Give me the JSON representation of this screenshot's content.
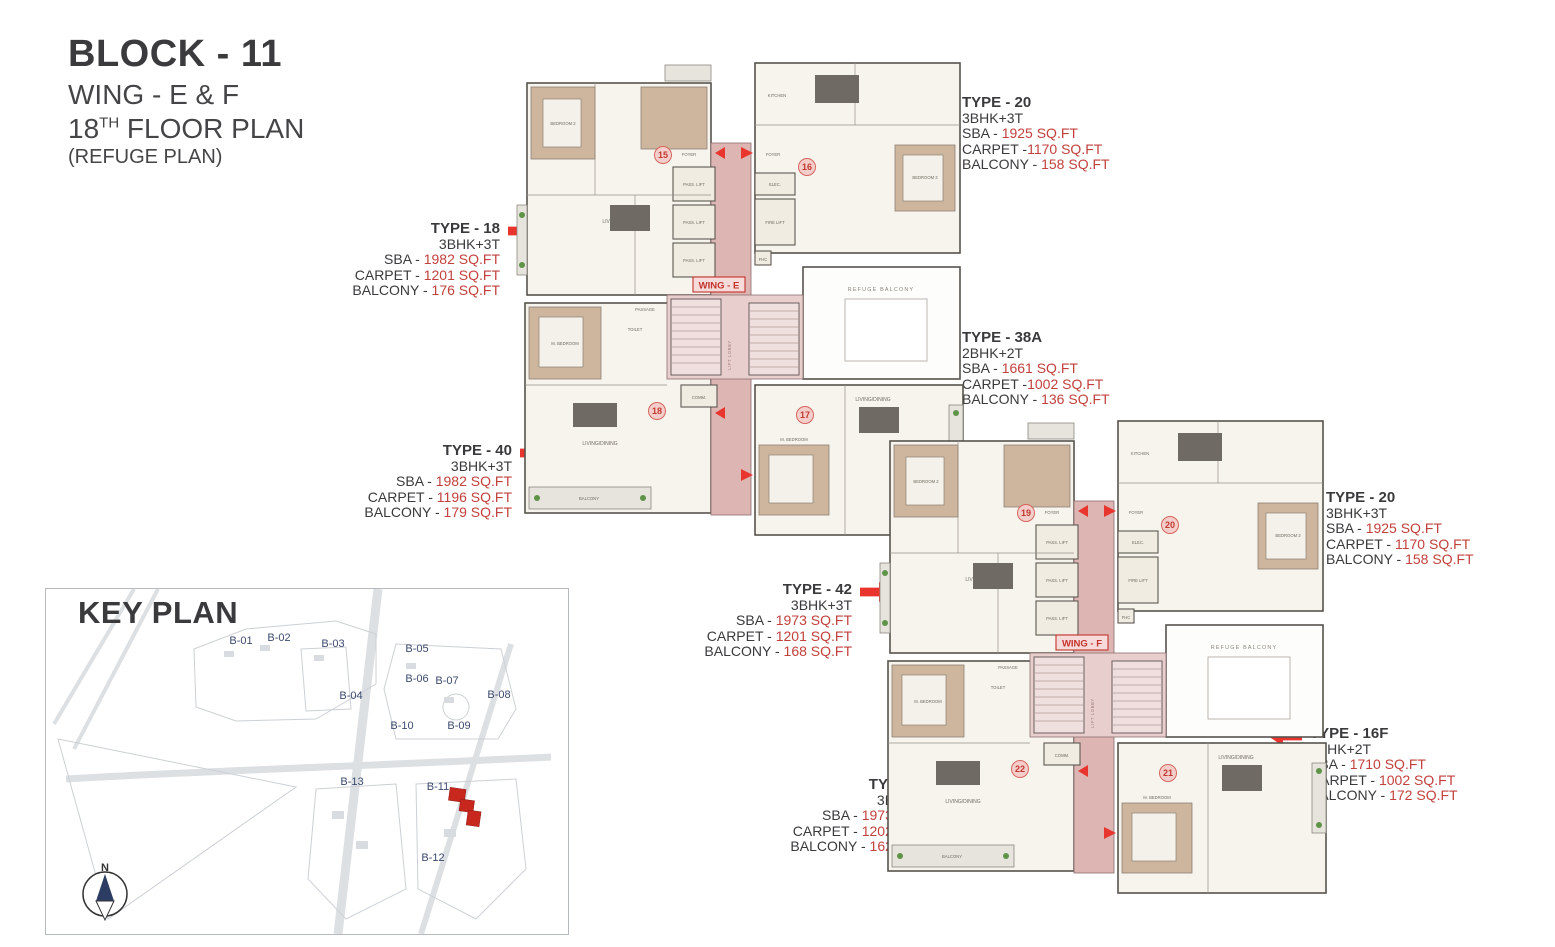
{
  "title": {
    "block": "BLOCK - 11",
    "wing": "WING - E & F",
    "floor_num": "18",
    "floor_sup": "TH",
    "floor_rest": " FLOOR PLAN",
    "subtitle": "(REFUGE PLAN)"
  },
  "colors": {
    "arrow_red": "#e8342c",
    "value_red": "#c2413d",
    "corridor_pink": "#ddb6b4",
    "keyplan_navy": "#3c4a6e"
  },
  "type_cards": [
    {
      "label": "TYPE - 20",
      "config": "3BHK+3T",
      "sba_label": "SBA - ",
      "sba": "1925 SQ.FT",
      "carpet_label": "CARPET -",
      "carpet": "1170 SQ.FT",
      "balcony_label": "BALCONY - ",
      "balcony": "158 SQ.FT"
    },
    {
      "label": "TYPE - 18",
      "config": "3BHK+3T",
      "sba_label": "SBA - ",
      "sba": "1982 SQ.FT",
      "carpet_label": "CARPET - ",
      "carpet": "1201 SQ.FT",
      "balcony_label": "BALCONY - ",
      "balcony": "176 SQ.FT"
    },
    {
      "label": "TYPE - 38A",
      "config": "2BHK+2T",
      "sba_label": "SBA - ",
      "sba": "1661 SQ.FT",
      "carpet_label": "CARPET -",
      "carpet": "1002 SQ.FT",
      "balcony_label": "BALCONY - ",
      "balcony": "136 SQ.FT"
    },
    {
      "label": "TYPE - 40",
      "config": "3BHK+3T",
      "sba_label": "SBA - ",
      "sba": "1982 SQ.FT",
      "carpet_label": "CARPET - ",
      "carpet": "1196 SQ.FT",
      "balcony_label": "BALCONY - ",
      "balcony": "179 SQ.FT"
    },
    {
      "label": "TYPE - 20",
      "config": "3BHK+3T",
      "sba_label": "SBA - ",
      "sba": "1925 SQ.FT",
      "carpet_label": "CARPET - ",
      "carpet": "1170 SQ.FT",
      "balcony_label": "BALCONY - ",
      "balcony": "158 SQ.FT"
    },
    {
      "label": "TYPE - 42",
      "config": "3BHK+3T",
      "sba_label": "SBA - ",
      "sba": "1973 SQ.FT",
      "carpet_label": "CARPET - ",
      "carpet": "1201 SQ.FT",
      "balcony_label": "BALCONY - ",
      "balcony": "168 SQ.FT"
    },
    {
      "label": "TYPE - 16F",
      "config": "2BHK+2T",
      "sba_label": "SBA - ",
      "sba": "1710 SQ.FT",
      "carpet_label": "CARPET - ",
      "carpet": "1002 SQ.FT",
      "balcony_label": "BALCONY - ",
      "balcony": "172 SQ.FT"
    },
    {
      "label": "TYPE - 41",
      "config": "3BHK+3T",
      "sba_label": "SBA - ",
      "sba": "1973 SQ.FT",
      "carpet_label": "CARPET - ",
      "carpet": "1202 SQ.FT",
      "balcony_label": "BALCONY - ",
      "balcony": "162 SQ.FT"
    }
  ],
  "wings": [
    {
      "name": "WING - E",
      "unit_tl": "15",
      "unit_tr": "16",
      "unit_bl": "18",
      "unit_br": "17"
    },
    {
      "name": "WING - F",
      "unit_tl": "19",
      "unit_tr": "20",
      "unit_bl": "22",
      "unit_br": "21"
    }
  ],
  "plan_labels": {
    "pass_lift": "PASS. LIFT",
    "fire_lift": "FIRE LIFT",
    "elec": "ELEC.",
    "fhc": "FHC",
    "comm": "COMM.",
    "refuge_balcony": "REFUGE BALCONY",
    "lift_lobby": "LIFT LOBBY",
    "foyer": "FOYER",
    "living": "LIVING/DINING",
    "kitchen": "KITCHEN",
    "master": "M. BEDROOM",
    "bedroom2": "BEDROOM 2",
    "bedroom3": "BEDROOM 3",
    "toilet": "TOILET",
    "passage": "PASSAGE",
    "balcony": "BALCONY"
  },
  "key_plan": {
    "title": "KEY PLAN",
    "blocks": [
      "B-01",
      "B-02",
      "B-03",
      "B-04",
      "B-05",
      "B-06",
      "B-07",
      "B-08",
      "B-09",
      "B-10",
      "B-11",
      "B-12",
      "B-13"
    ],
    "compass": "N"
  }
}
